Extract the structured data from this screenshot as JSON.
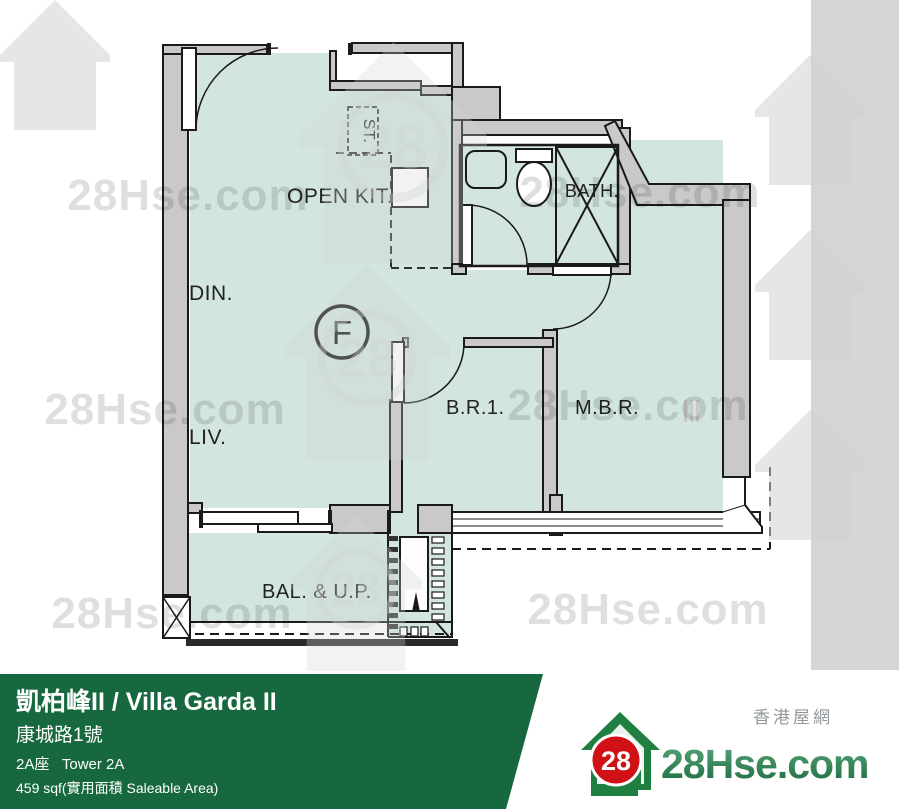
{
  "floor_plan": {
    "unit_label": "F",
    "labels": {
      "open_kitchen": "OPEN KIT.",
      "store": "ST.",
      "bath": "BATH.",
      "dining": "DIN.",
      "living": "LIV.",
      "bedroom_1": "B.R.1.",
      "master_bedroom": "M.B.R.",
      "balcony": "BAL. & U.P."
    },
    "watermark_text": "28Hse.com",
    "colors": {
      "room_fill": "#d3e5e1",
      "wall_fill": "#c9c9c9",
      "line": "#1a1a1a",
      "side_strip": "#d5d5d5"
    }
  },
  "info_bar": {
    "title": "凱柏峰II / Villa Garda II",
    "address": "康城路1號",
    "tower": "2A座   Tower 2A",
    "area": "459 sqf(實用面積 Saleable Area)",
    "bg_color": "#17683f"
  },
  "brand": {
    "badge": "28",
    "site": "28Hse.com",
    "site_cn": "香港屋網",
    "green": "#2e8b57",
    "red": "#d01217"
  }
}
